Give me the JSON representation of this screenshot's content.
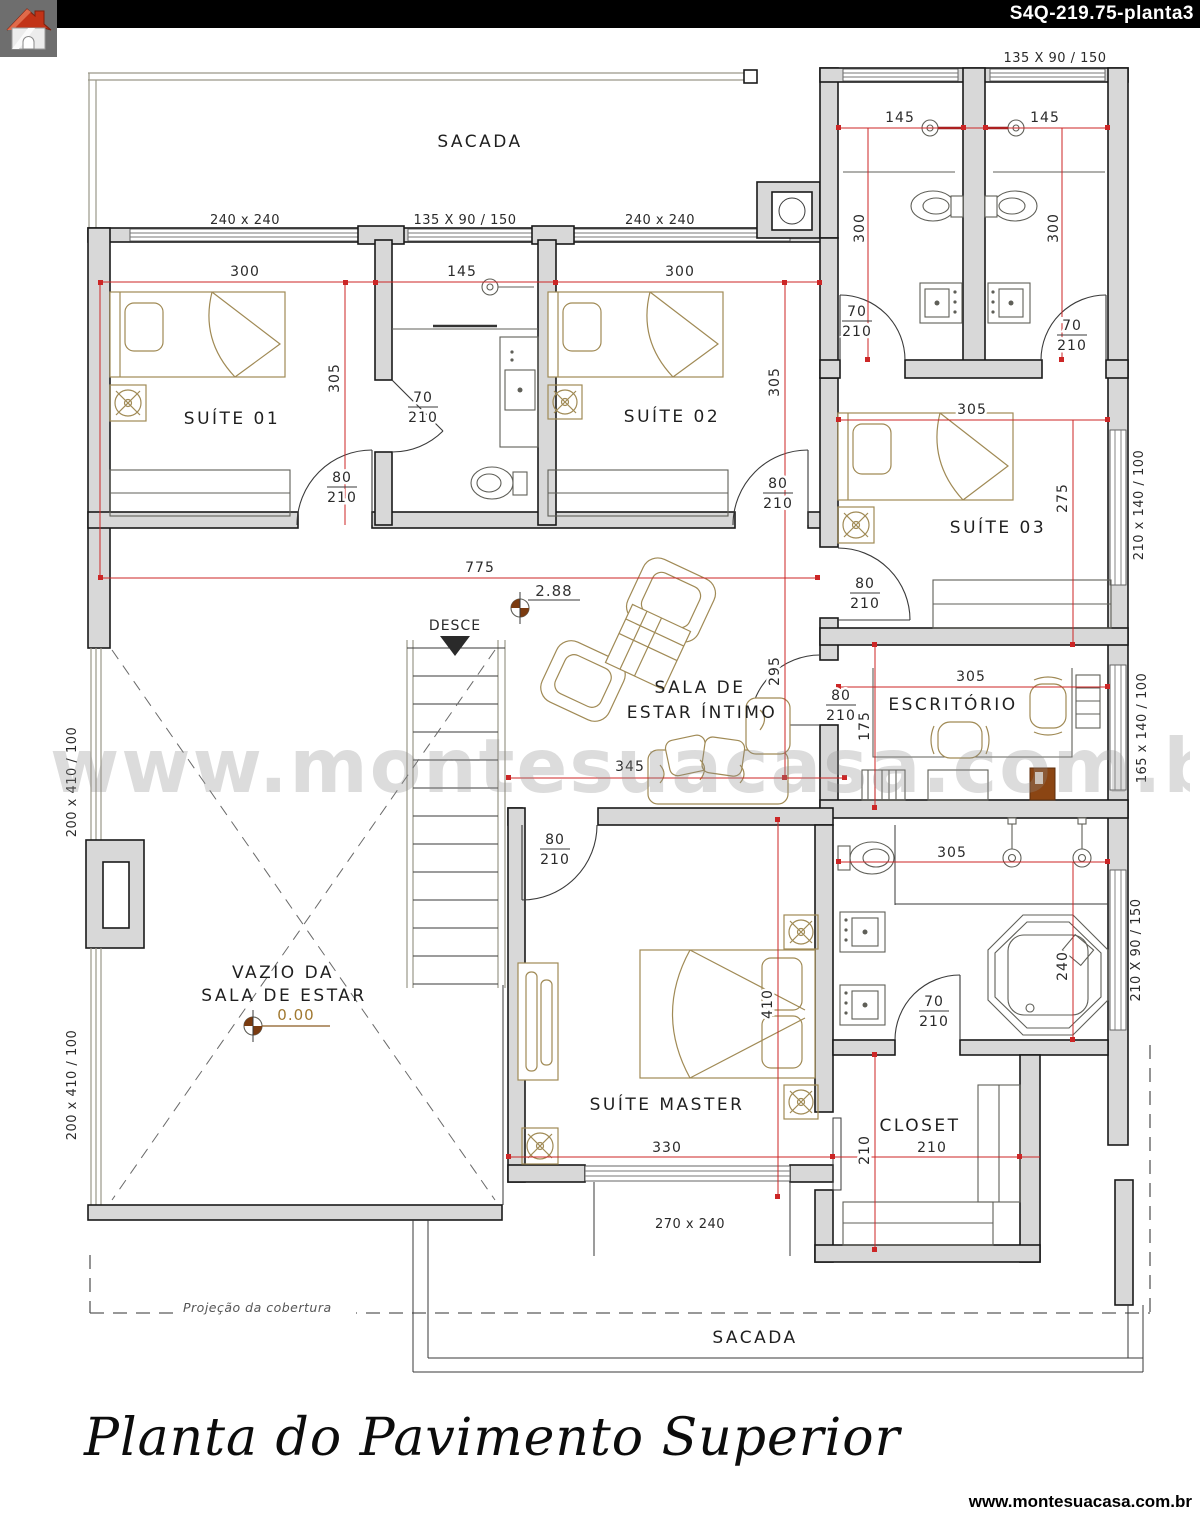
{
  "header": {
    "drawing_code": "S4Q-219.75-planta3"
  },
  "branding": {
    "watermark": "www.montesuacasa.com.br",
    "site_url": "www.montesuacasa.com.br"
  },
  "title_block": {
    "plan_title": "Planta do Pavimento Superior"
  },
  "rooms": {
    "balcony_top": "SACADA",
    "suite1": "SUÍTE 01",
    "suite2": "SUÍTE 02",
    "suite3": "SUÍTE 03",
    "office": "ESCRITÓRIO",
    "living_line1": "SALA DE",
    "living_line2": "ESTAR ÍNTIMO",
    "void_line1": "VAZIO DA",
    "void_line2": "SALA DE ESTAR",
    "master": "SUÍTE MASTER",
    "closet": "CLOSET",
    "balcony_bottom": "SACADA"
  },
  "stairs": {
    "direction_label": "DESCE"
  },
  "levels": {
    "upper_floor": "2.88",
    "lower_floor": "0.00"
  },
  "roof": {
    "projection_label": "Projeção da cobertura"
  },
  "window_specs": {
    "top_left": "240 x 240",
    "top_center": "135 X 90 / 150",
    "top_right": "240 x 240",
    "wc_top": "135 X 90 / 150",
    "suite3_side": "210 x 140 / 100",
    "office_side": "165 x 140 / 100",
    "master_bath_side": "210 X 90 / 150",
    "master_bottom": "270 x 240",
    "void_side_upper": "200 x 410 / 100",
    "void_side_lower": "200 x 410 / 100"
  },
  "dimensions": {
    "suite1_width": "300",
    "mid_bath_width": "145",
    "suite2_width": "300",
    "wc1_width": "145",
    "wc2_width": "145",
    "wc1_depth": "300",
    "wc2_depth": "300",
    "suite1_depth": "305",
    "suite2_depth": "305",
    "hall_span": "775",
    "suite3_width": "305",
    "suite3_depth": "275",
    "office_width": "305",
    "office_depth": "175",
    "living_depth": "295",
    "sofa_span": "345",
    "master_bath_width": "305",
    "master_bath_depth": "240",
    "master_depth": "410",
    "master_width": "330",
    "closet_depth": "210",
    "closet_width": "210"
  },
  "doors": {
    "w70": "70",
    "w80": "80",
    "h210": "210"
  }
}
